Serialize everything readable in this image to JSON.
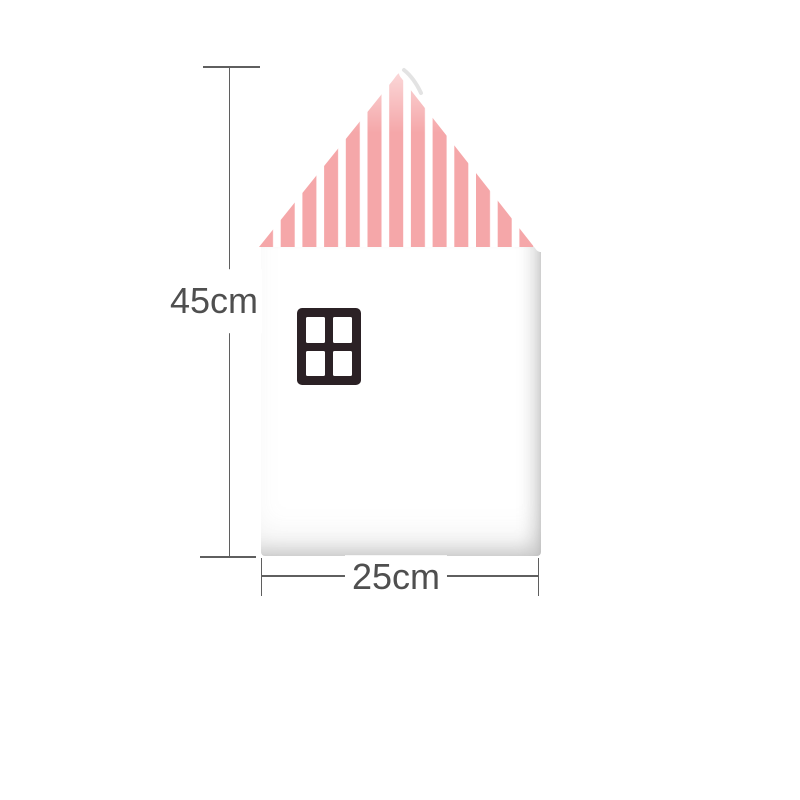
{
  "figure": {
    "type": "product-dimension-diagram",
    "subject": "house-shaped wall pad with striped roof and window",
    "height_label": "45cm",
    "width_label": "25cm"
  },
  "colors": {
    "background": "#ffffff",
    "stripe_pink": "#f5a7a9",
    "window_frame": "#2b2125",
    "window_pane": "#ffffff",
    "dimension_line": "#5f5f5f",
    "label_text": "#4f4f4f",
    "body_shadow": "#dcdcdc"
  }
}
